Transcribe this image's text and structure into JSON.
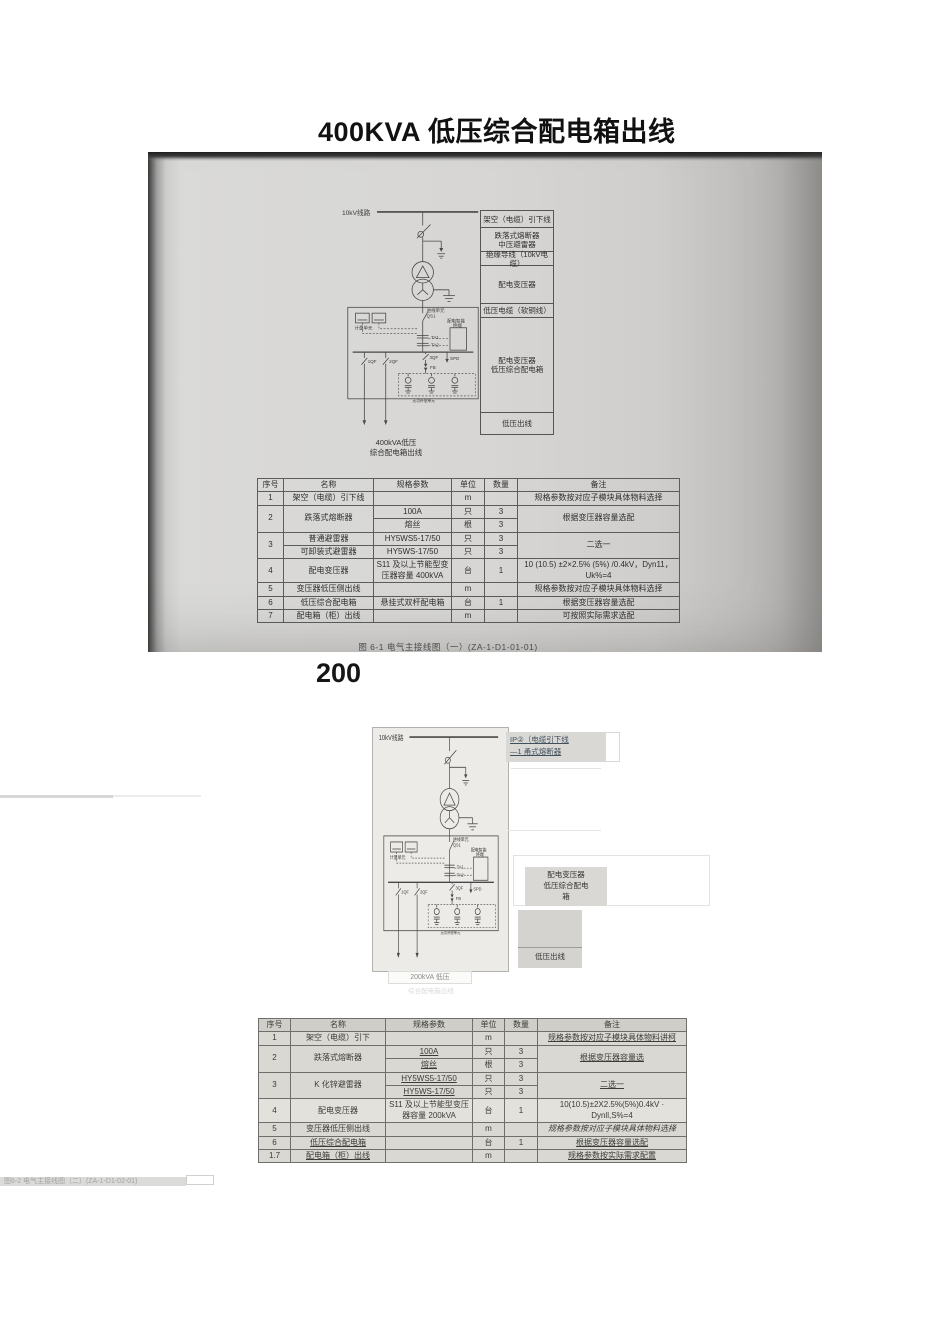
{
  "page": {
    "title": "400KVA 低压综合配电箱出线",
    "section_marker": "200"
  },
  "schematic": {
    "feeder": "10kV线路",
    "incoming_unit": "进线单元",
    "qs1": "QS1",
    "metering": "计量单元",
    "ta1": "TA1",
    "ta2": "TA2",
    "terminal_line1": "配电智能",
    "terminal_line2": "终端",
    "qf1": "1QF",
    "qf2": "2QF",
    "qf3": "3QF",
    "spd": "SPD",
    "fb": "FB",
    "compensation": "无功补偿单元"
  },
  "photo": {
    "caption": "图 6-1  电气主接线图（一）(ZA-1-D1-01-01)",
    "diagram": {
      "outgoing_label": "400kVA低压\n综合配电箱出线",
      "side_labels": [
        "架空（电缆）引下线",
        "跌落式熔断器\n中压避雷器",
        "绝缘导线（10kV电缆）",
        "配电变压器",
        "低压电缆（软铜线）",
        "配电变压器\n低压综合配电箱",
        "低压出线"
      ]
    },
    "table": {
      "headers": [
        "序号",
        "名称",
        "规格参数",
        "单位",
        "数量",
        "备注"
      ],
      "rows": [
        [
          "1",
          "架空（电缆）引下线",
          "",
          "m",
          "",
          "规格参数按对应子模块具体物料选择"
        ],
        [
          "2",
          "跌落式熔断器",
          "100A",
          "只",
          "3",
          "根据变压器容量选配"
        ],
        [
          "熔丝",
          "根",
          "3"
        ],
        [
          "3",
          "普通避雷器",
          "HY5WS5-17/50",
          "只",
          "3",
          "二选一"
        ],
        [
          "可卸装式避雷器",
          "HY5WS-17/50",
          "只",
          "3"
        ],
        [
          "4",
          "配电变压器",
          "S11 及以上节能型变压器容量 400kVA",
          "台",
          "1",
          "10 (10.5) ±2×2.5% (5%) /0.4kV，Dyn11，Uk%=4"
        ],
        [
          "5",
          "变压器低压侧出线",
          "",
          "m",
          "",
          "规格参数按对应子模块具体物料选择"
        ],
        [
          "6",
          "低压综合配电箱",
          "悬挂式双杆配电箱",
          "台",
          "1",
          "根据变压器容量选配"
        ],
        [
          "7",
          "配电箱（柜）出线",
          "",
          "m",
          "",
          "可按照实际需求选配"
        ]
      ]
    }
  },
  "diagram2": {
    "callout_top_line1": "IP②（电缆引下线",
    "callout_top_line2": "—1 甬式熔断器",
    "callout_mid": "配电变压器\n低压综合配电\n箱",
    "lv_out_label": "低压出线",
    "bottom_label": "200kVA 低压",
    "bottom_label_faint": "综合配电箱出线"
  },
  "table2": {
    "headers": [
      "序号",
      "名称",
      "规格参数",
      "单位",
      "数量",
      "备注"
    ],
    "rows": [
      [
        "1",
        "架空（电缆）引下",
        "",
        "m",
        "",
        "规格参数按对应子模块具体物料讲柯"
      ],
      [
        "2",
        "跌落式熔断器",
        "100A",
        "只",
        "3",
        "根据变压器容量选"
      ],
      [
        "熔丝",
        "根",
        "3"
      ],
      [
        "3",
        "K 化锌避雷器",
        "HY5WS5-17/50",
        "只",
        "3",
        "二选一"
      ],
      [
        "HY5WS-17/50",
        "只",
        "3"
      ],
      [
        "4",
        "配电变压器",
        "S11 及以上节能型变压器容量 200kVA",
        "台",
        "1",
        "10(10.5)±2X2.5%(5%)0.4kV · Dynll,S%=4"
      ],
      [
        "5",
        "变压器低压侧出线",
        "",
        "m",
        "",
        "规格参数按对应子模块具体物料选择"
      ],
      [
        "6",
        "低压综合配电箱",
        "",
        "台",
        "1",
        "根据变压器容量选配"
      ],
      [
        "1.7",
        "配电箱（柜）出线",
        "",
        "m",
        "",
        "规格参数按实际需求配置"
      ]
    ]
  },
  "footer": {
    "caption_faint": "图6-2  电气主接线图（二）(ZA-1-D1-02-01)"
  }
}
